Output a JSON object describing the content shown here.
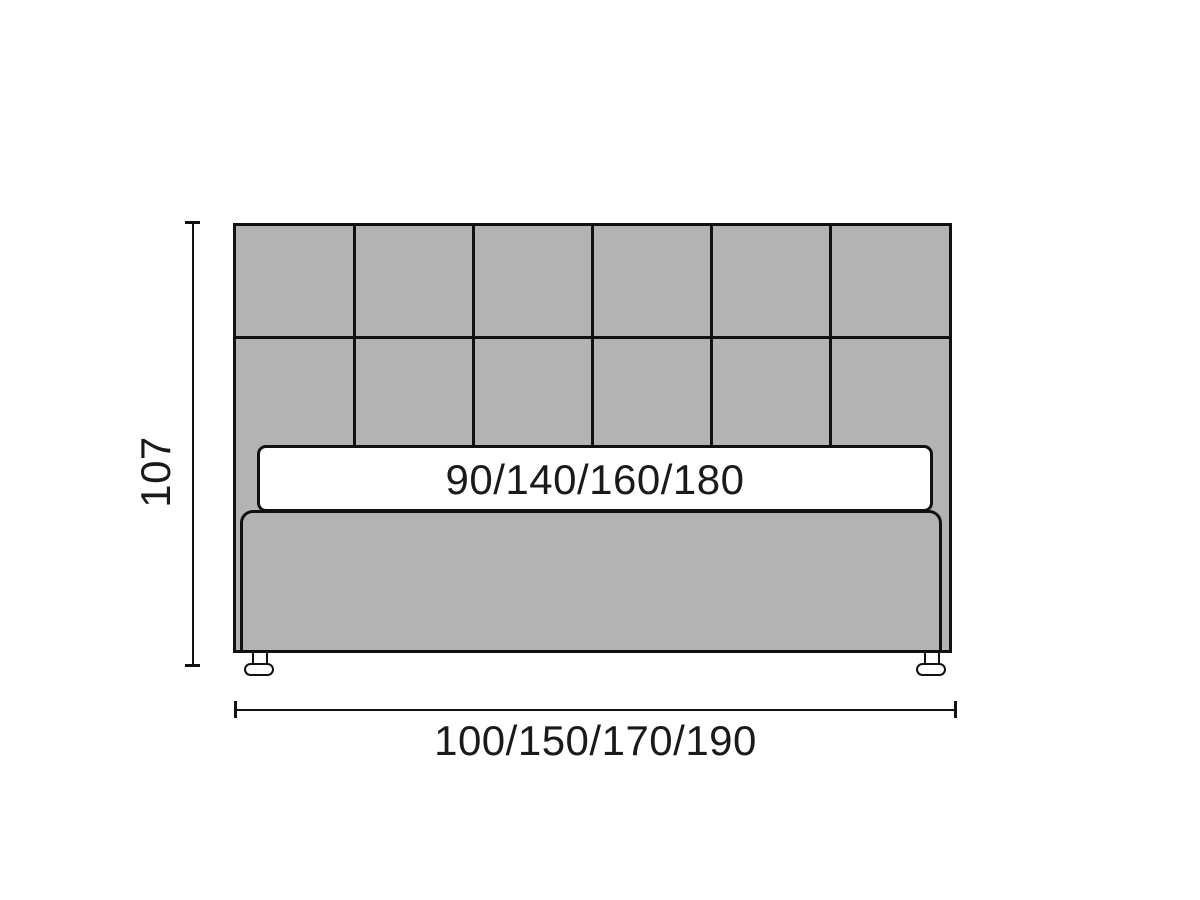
{
  "diagram": {
    "type": "bed-front-elevation-dimension-diagram",
    "labels": {
      "height": "107",
      "width": "100/150/170/190",
      "mattress": "90/140/160/180"
    },
    "colors": {
      "page_background": "#ffffff",
      "upholstery_gray": "#b3b3b3",
      "outline_black": "#111111",
      "mattress_white": "#ffffff",
      "label_text": "#1a1a1a"
    },
    "headboard_grid": {
      "rows": 2,
      "columns": 6
    }
  }
}
